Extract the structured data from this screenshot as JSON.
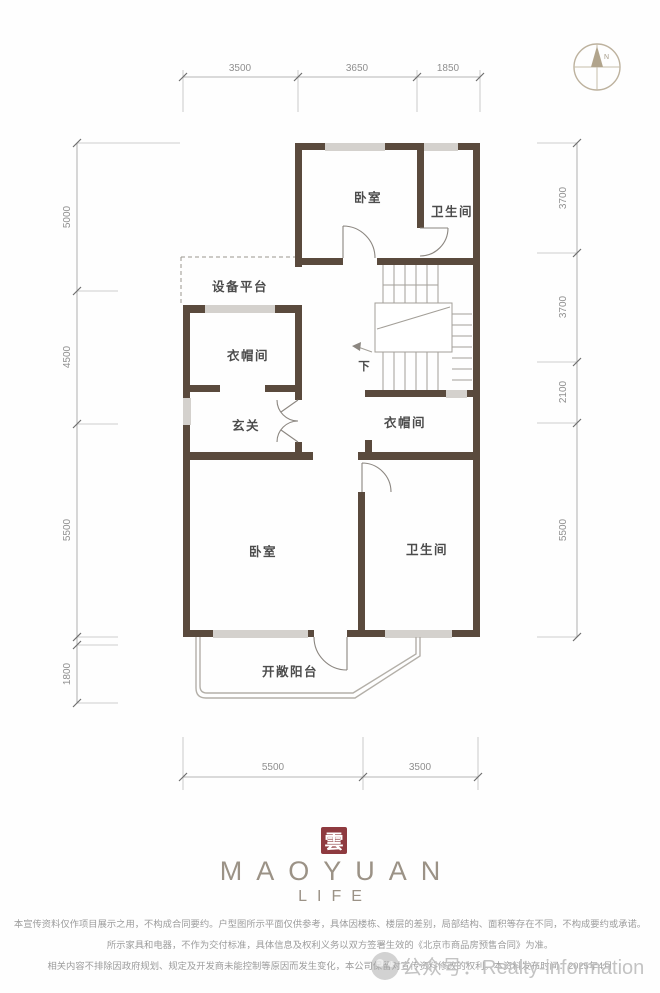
{
  "dimensions": {
    "top": [
      "3500",
      "3650",
      "1850"
    ],
    "left": [
      "5000",
      "4500",
      "5500",
      "1800"
    ],
    "right": [
      "3700",
      "3700",
      "2100",
      "5500"
    ],
    "bottom": [
      "5500",
      "3500"
    ]
  },
  "compass": {
    "north": "N"
  },
  "rooms": {
    "bedroom_top": "卧室",
    "bathroom_top": "卫生间",
    "equipment_platform": "设备平台",
    "cloakroom_left": "衣帽间",
    "foyer": "玄关",
    "stairs_down": "下",
    "cloakroom_right": "衣帽间",
    "bedroom_lower": "卧室",
    "bathroom_lower": "卫生间",
    "balcony": "开敞阳台"
  },
  "logo": {
    "seal": "雲",
    "brand": "MAOYUAN",
    "subbrand": "LIFE"
  },
  "disclaimer": {
    "line1": "本宣传资料仅作项目展示之用，不构成合同要约。户型图所示平面仅供参考，具体因楼栋、楼层的差别，局部结构、面积等存在不同，不构成要约或承诺。",
    "line2": "所示家具和电器，不作为交付标准，具体信息及权利义务以双方签署生效的《北京市商品房预售合同》为准。",
    "line3": "相关内容不排除因政府规划、规定及开发商未能控制等原因而发生变化，本公司保留对宣传资料修改的权利。本资料发布时间：2025年4月"
  },
  "watermark": {
    "label": "公众号：Realty-information"
  },
  "colors": {
    "wall": "#5a4a3d",
    "seal_red": "#8e3a3f",
    "brand_taupe": "#9b9286",
    "dim_text": "#8f8f8f",
    "label_text": "#4c4c4c",
    "watermark_gray": "#bfbfbf"
  }
}
